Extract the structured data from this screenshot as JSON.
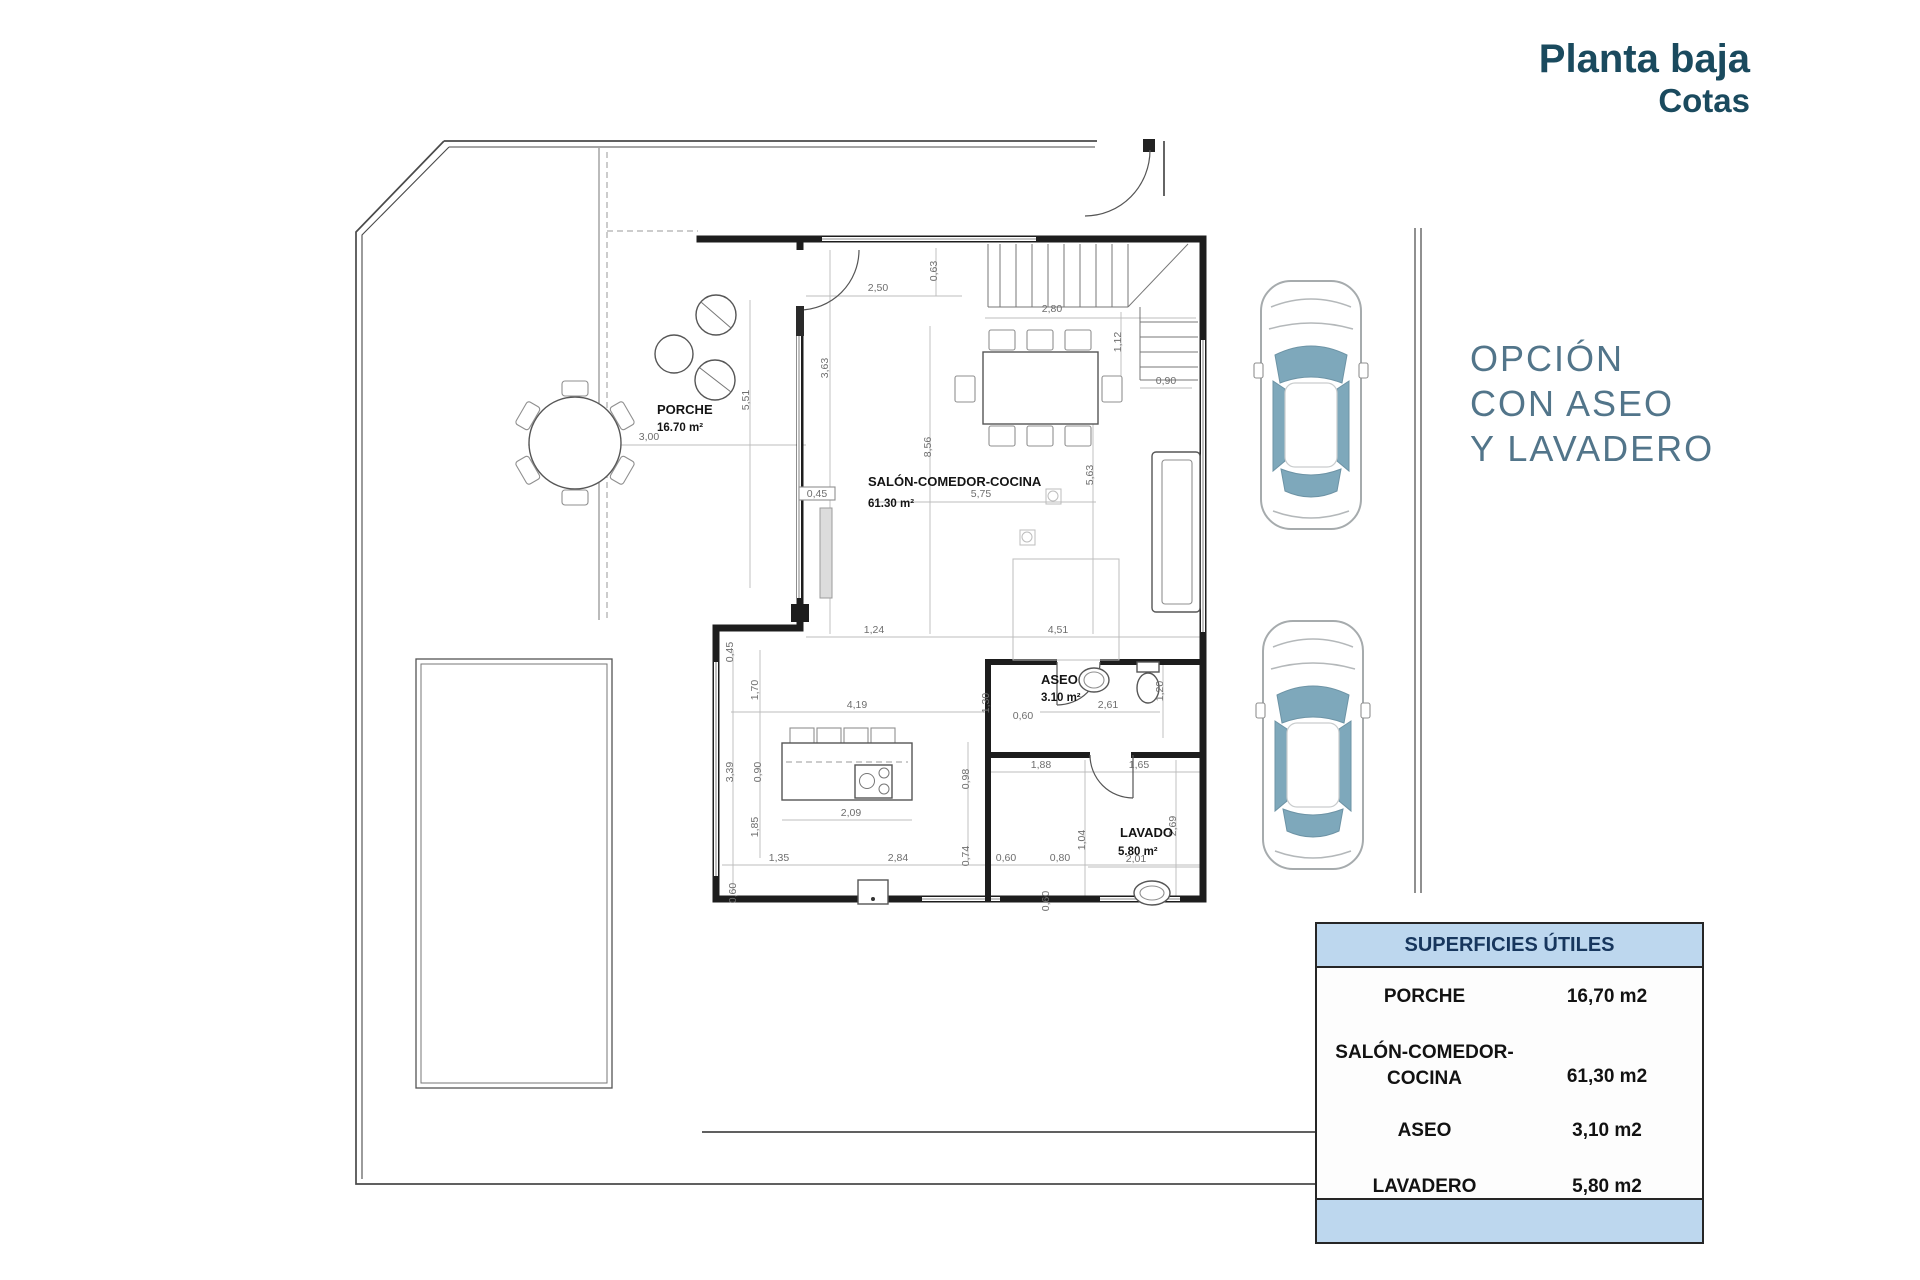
{
  "header": {
    "title": "Planta baja",
    "subtitle": "Cotas"
  },
  "option_note": {
    "lines": [
      "OPCIÓN",
      "CON ASEO",
      "Y LAVADERO"
    ]
  },
  "surfaces_table": {
    "header": "SUPERFICIES ÚTILES",
    "rows": [
      {
        "name": "PORCHE",
        "value": "16,70 m2"
      },
      {
        "name_lines": [
          "SALÓN-COMEDOR-",
          "COCINA"
        ],
        "value": "61,30 m2"
      },
      {
        "name": "ASEO",
        "value": "3,10 m2"
      },
      {
        "name": "LAVADERO",
        "value": "5,80 m2"
      }
    ]
  },
  "plan": {
    "rooms": [
      {
        "name": "PORCHE",
        "area": "16.70 m²"
      },
      {
        "name": "SALÓN-COMEDOR-COCINA",
        "area": "61.30 m²"
      },
      {
        "name": "ASEO",
        "area": "3.10 m²"
      },
      {
        "name": "LAVADO",
        "area": "5.80 m²"
      }
    ],
    "dimension_labels": [
      {
        "v": "2,50",
        "x": 878,
        "y": 291
      },
      {
        "v": "0,63",
        "x": 937,
        "y": 271,
        "r": -90
      },
      {
        "v": "2,80",
        "x": 1052,
        "y": 312
      },
      {
        "v": "1,12",
        "x": 1121,
        "y": 342,
        "r": -90
      },
      {
        "v": "0,90",
        "x": 1166,
        "y": 384
      },
      {
        "v": "5,51",
        "x": 749,
        "y": 400,
        "r": -90
      },
      {
        "v": "3,00",
        "x": 649,
        "y": 440
      },
      {
        "v": "3,63",
        "x": 828,
        "y": 368,
        "r": -90
      },
      {
        "v": "8,56",
        "x": 931,
        "y": 447,
        "r": -90
      },
      {
        "v": "5,75",
        "x": 981,
        "y": 497
      },
      {
        "v": "5,63",
        "x": 1093,
        "y": 475,
        "r": -90
      },
      {
        "v": "0,45",
        "x": 817,
        "y": 497
      },
      {
        "v": "1,24",
        "x": 874,
        "y": 633
      },
      {
        "v": "4,51",
        "x": 1058,
        "y": 633
      },
      {
        "v": "0,45",
        "x": 733,
        "y": 652,
        "r": -90
      },
      {
        "v": "1,70",
        "x": 758,
        "y": 690,
        "r": -90
      },
      {
        "v": "3,39",
        "x": 733,
        "y": 772,
        "r": -90
      },
      {
        "v": "0,90",
        "x": 761,
        "y": 772,
        "r": -90
      },
      {
        "v": "1,85",
        "x": 758,
        "y": 827,
        "r": -90
      },
      {
        "v": "4,19",
        "x": 857,
        "y": 708
      },
      {
        "v": "2,09",
        "x": 851,
        "y": 816
      },
      {
        "v": "1,35",
        "x": 779,
        "y": 861
      },
      {
        "v": "2,84",
        "x": 898,
        "y": 861
      },
      {
        "v": "0,74",
        "x": 969,
        "y": 856,
        "r": -90
      },
      {
        "v": "0,60",
        "x": 1006,
        "y": 861
      },
      {
        "v": "0,80",
        "x": 1060,
        "y": 861
      },
      {
        "v": "0,60",
        "x": 736,
        "y": 893,
        "r": -90
      },
      {
        "v": "1,30",
        "x": 989,
        "y": 703,
        "r": -90
      },
      {
        "v": "0,60",
        "x": 1023,
        "y": 719
      },
      {
        "v": "2,61",
        "x": 1108,
        "y": 708
      },
      {
        "v": "1,20",
        "x": 1163,
        "y": 691,
        "r": -90
      },
      {
        "v": "1,88",
        "x": 1041,
        "y": 768
      },
      {
        "v": "1,65",
        "x": 1139,
        "y": 768
      },
      {
        "v": "0,98",
        "x": 969,
        "y": 779,
        "r": -90
      },
      {
        "v": "1,04",
        "x": 1085,
        "y": 840,
        "r": -90
      },
      {
        "v": "2,69",
        "x": 1176,
        "y": 826,
        "r": -90
      },
      {
        "v": "2,01",
        "x": 1136,
        "y": 862
      },
      {
        "v": "0,60",
        "x": 1049,
        "y": 901,
        "r": -90
      }
    ]
  },
  "colors": {
    "accent_dark": "#1a4a5e",
    "accent_muted": "#52758a",
    "table_header_bg": "#bdd7ee",
    "car_glass": "#7ea8bb"
  }
}
